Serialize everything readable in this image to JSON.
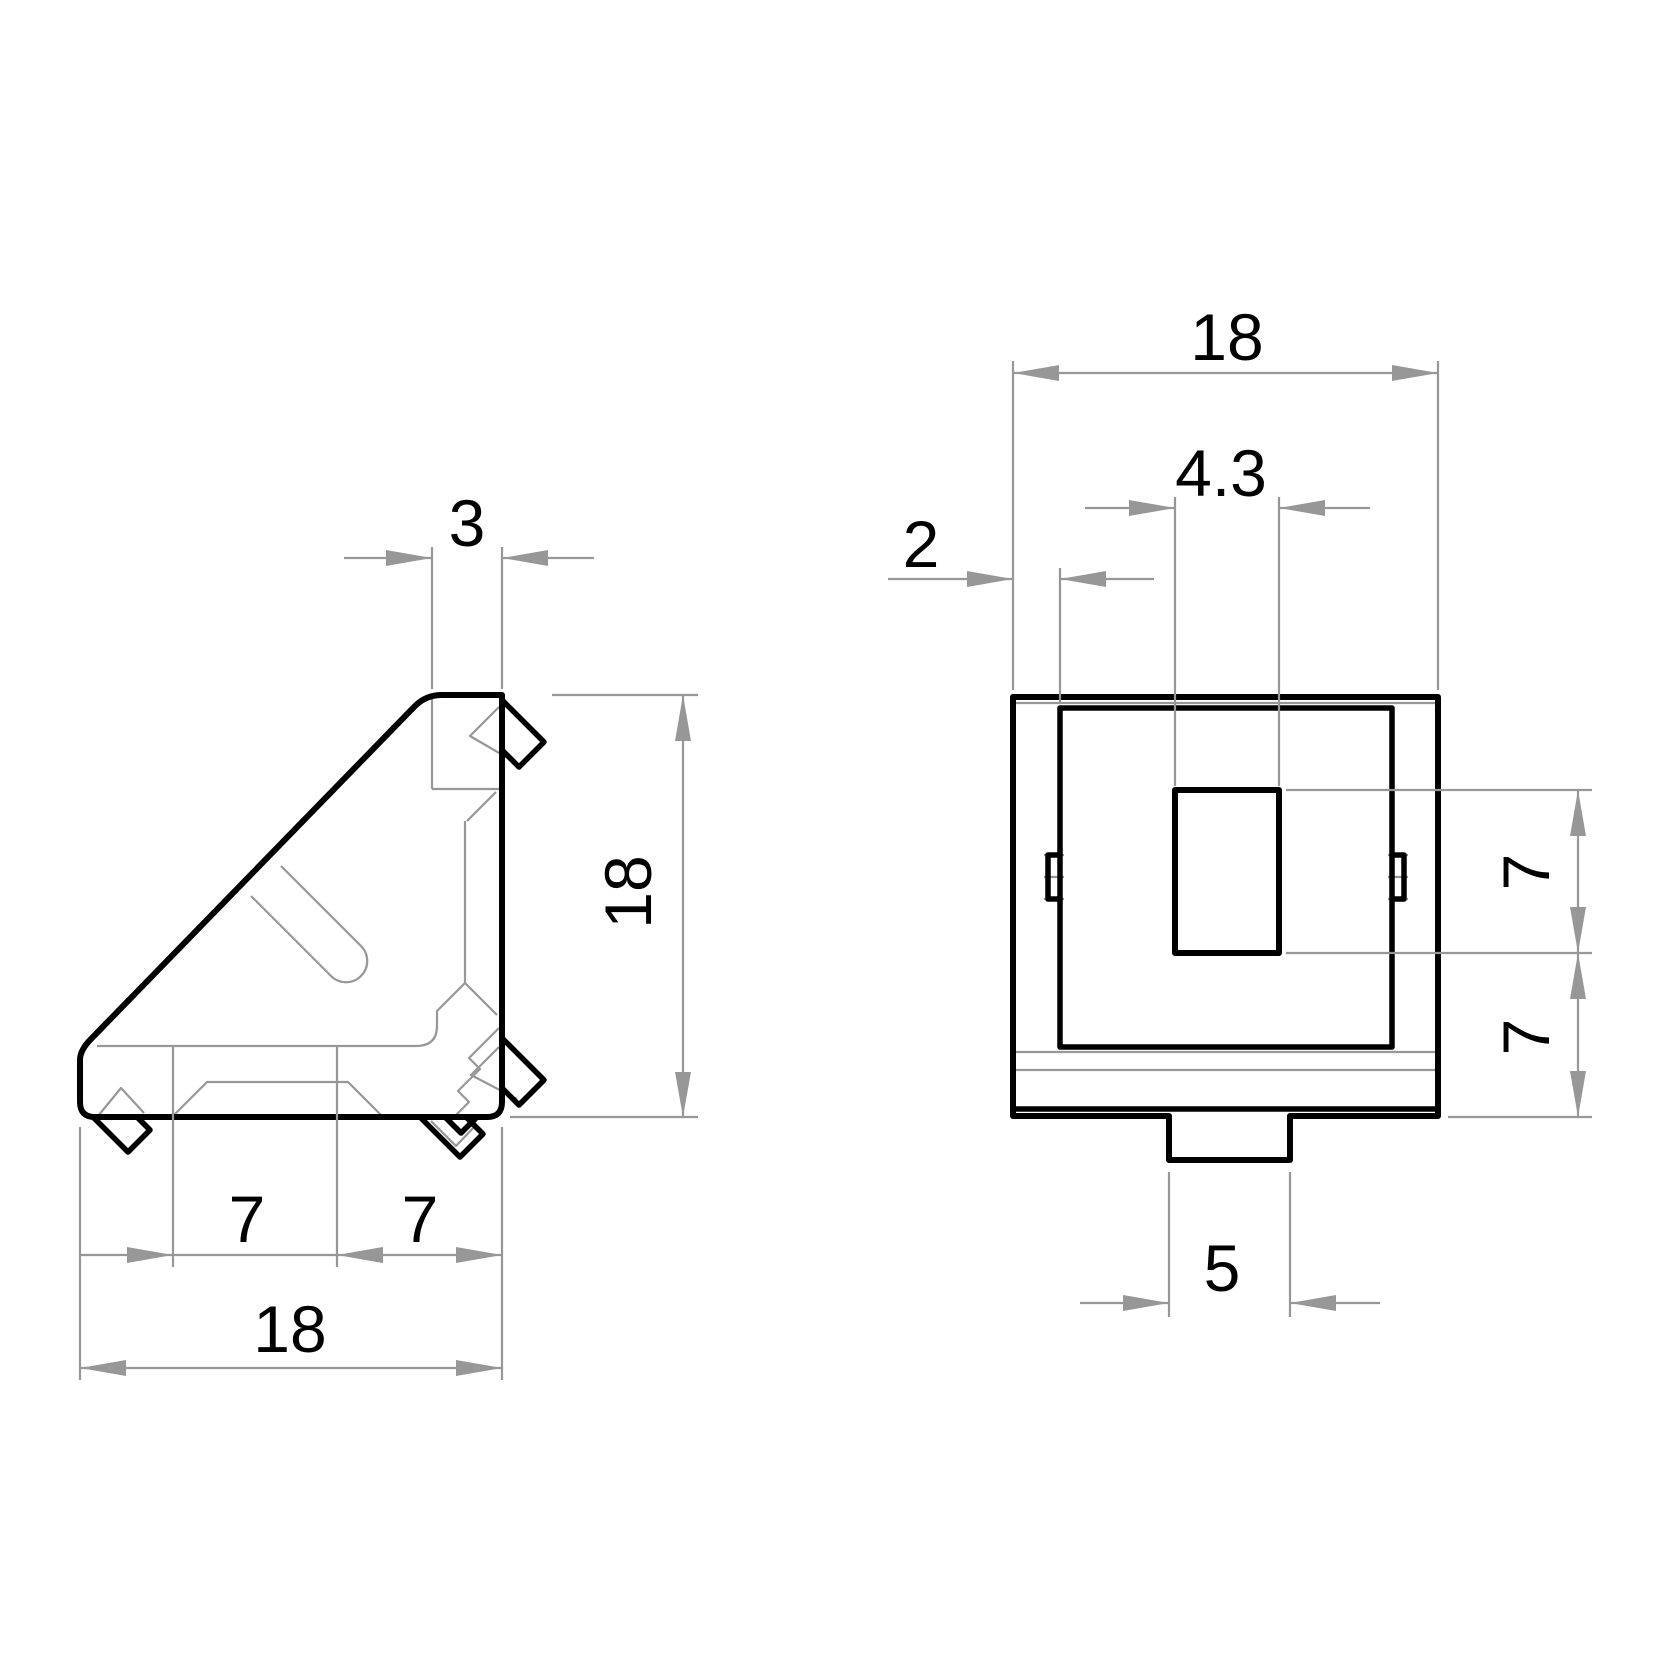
{
  "views": {
    "side": {
      "label_top_wall": "3",
      "label_height": "18",
      "label_bottom_left": "7",
      "label_bottom_right": "7",
      "label_width": "18"
    },
    "front": {
      "label_width": "18",
      "label_slot_width": "4.3",
      "label_wall": "2",
      "label_slot_height": "7",
      "label_bottom_offset": "7",
      "label_tab_width": "5"
    }
  },
  "colors": {
    "outline": "#000000",
    "dimension": "#979797",
    "text": "#000000"
  }
}
